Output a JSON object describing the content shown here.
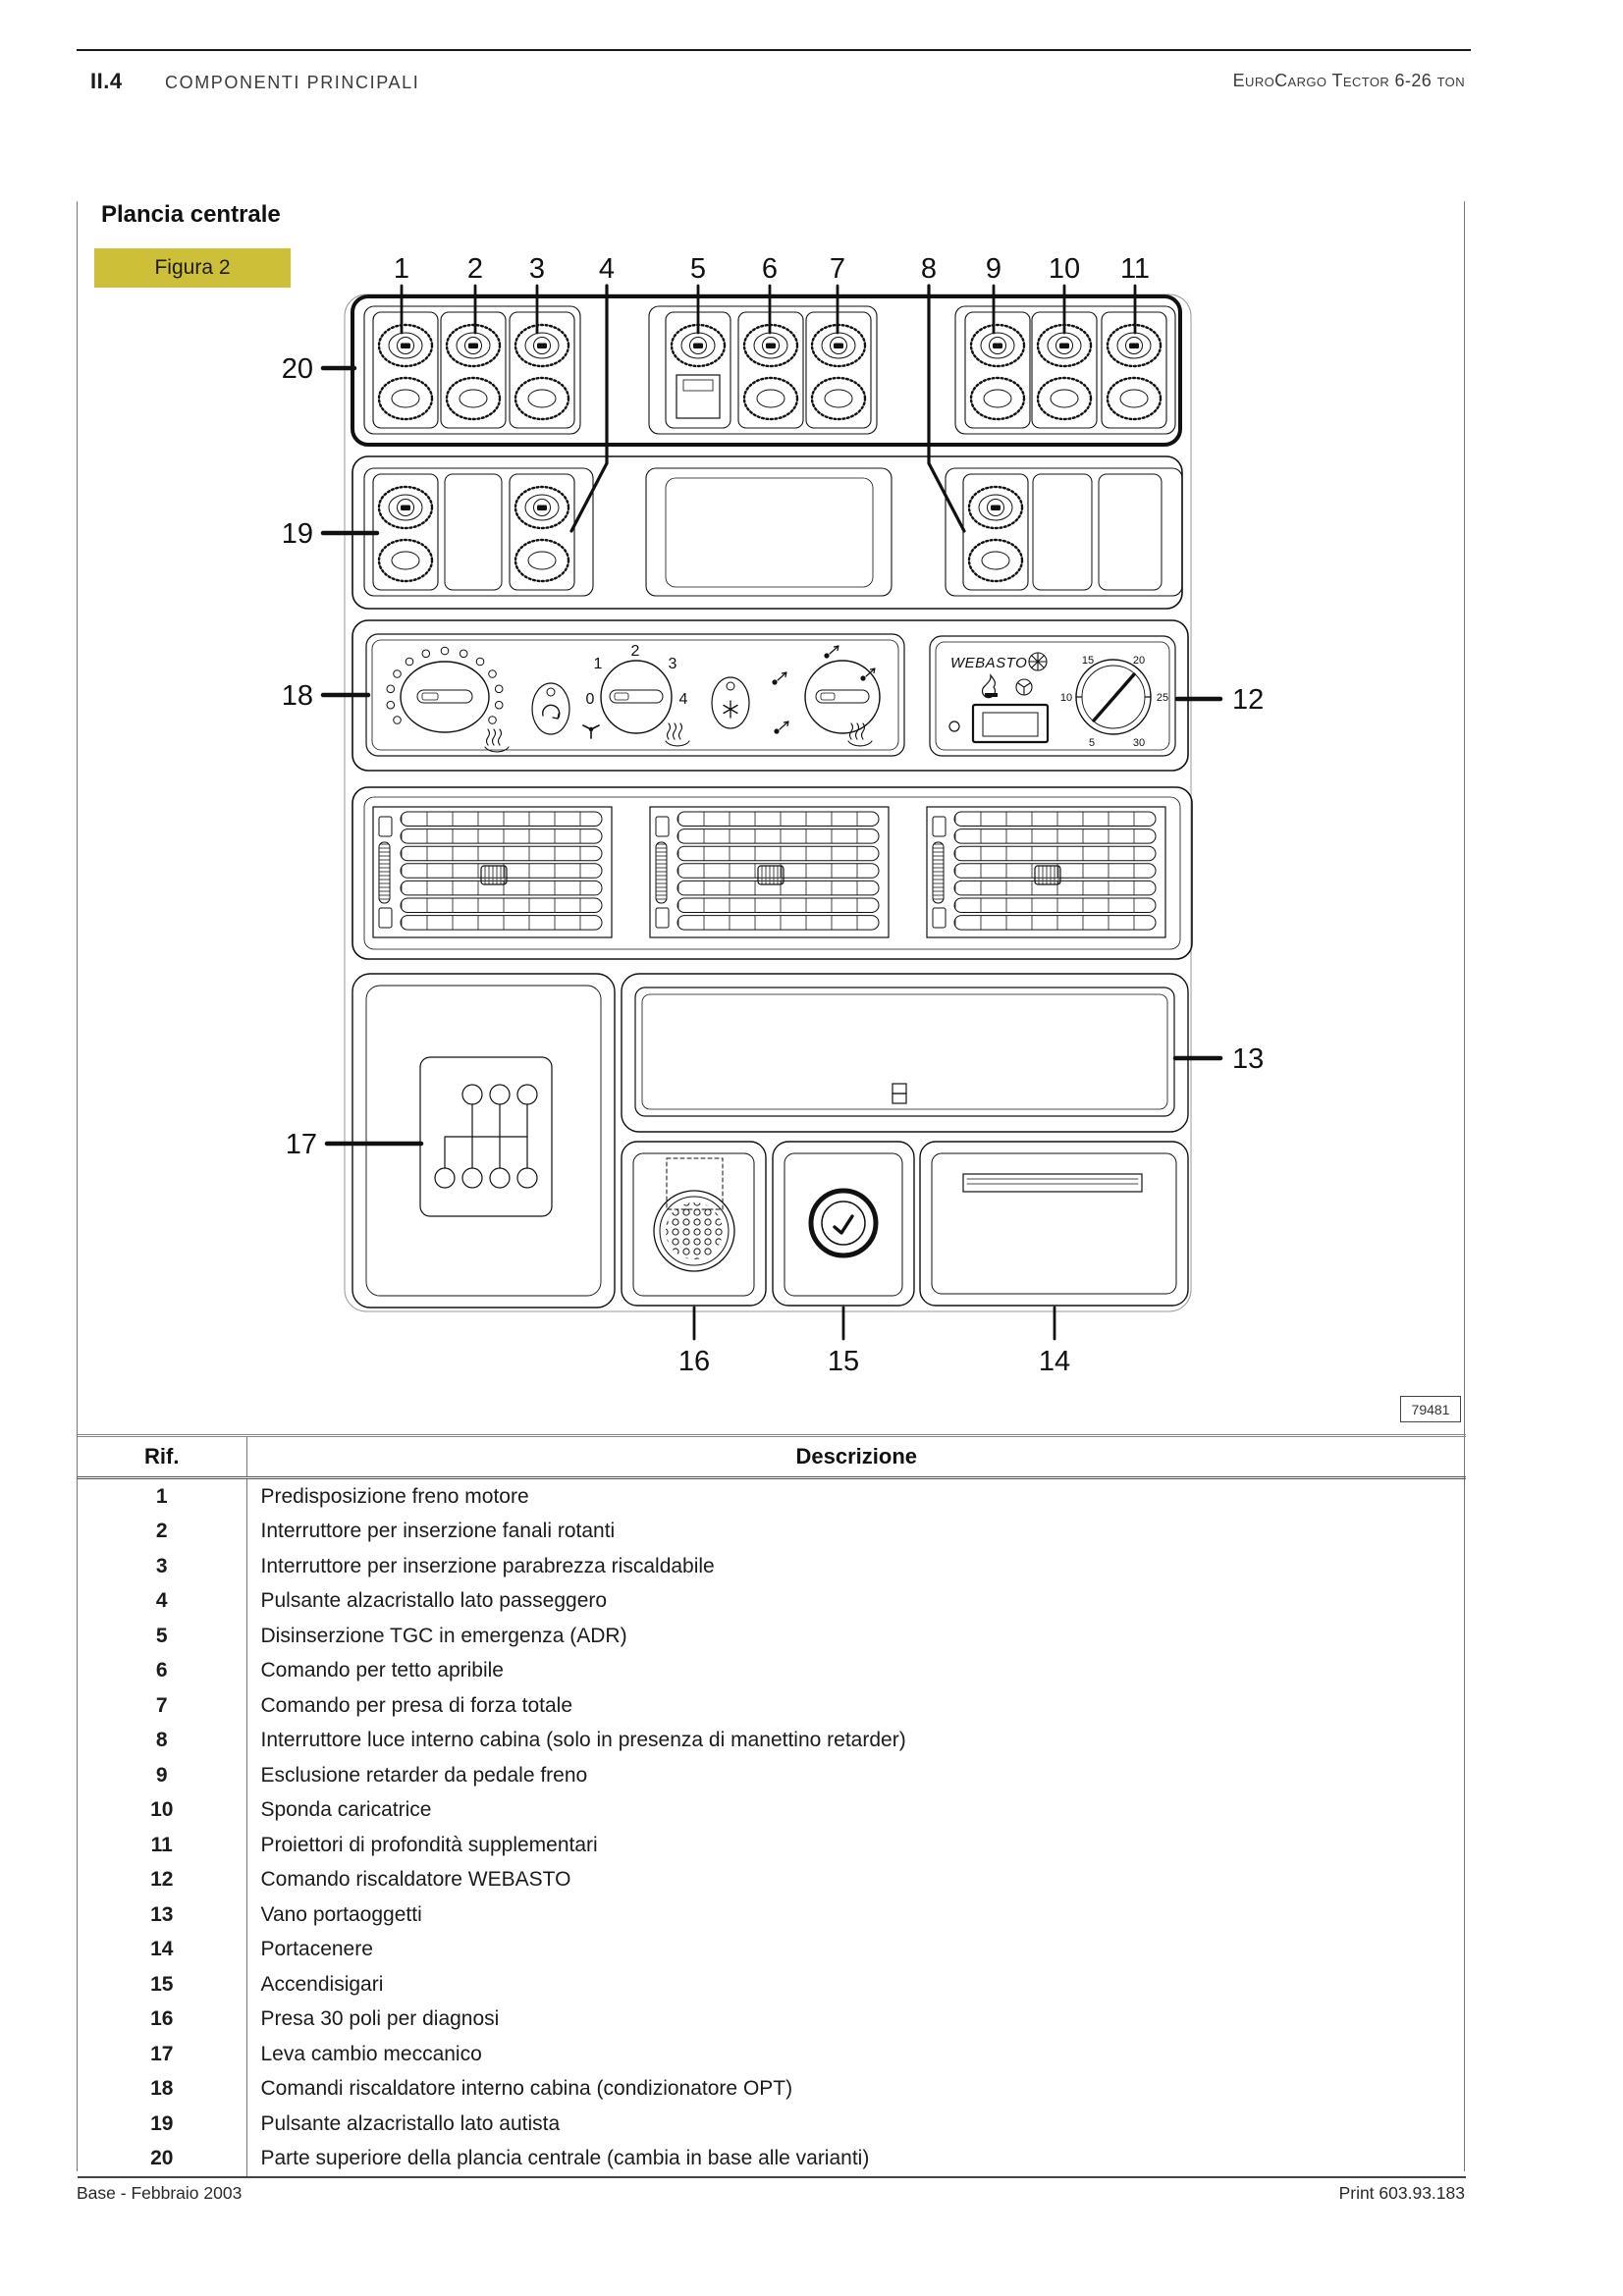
{
  "header": {
    "section": "II.4",
    "title": "COMPONENTI PRINCIPALI",
    "edition": "EuroCargo Tector 6-26 ton"
  },
  "figure": {
    "heading": "Plancia centrale",
    "label": "Figura 2",
    "code": "79481",
    "accent_color": "#cdbf37",
    "callouts": {
      "c1": "1",
      "c2": "2",
      "c3": "3",
      "c4": "4",
      "c5": "5",
      "c6": "6",
      "c7": "7",
      "c8": "8",
      "c9": "9",
      "c10": "10",
      "c11": "11",
      "c12": "12",
      "c13": "13",
      "c14": "14",
      "c15": "15",
      "c16": "16",
      "c17": "17",
      "c18": "18",
      "c19": "19",
      "c20": "20"
    },
    "webasto": {
      "brand": "WEBASTO",
      "dial": [
        "15",
        "20",
        "10",
        "25",
        "5",
        "30"
      ]
    },
    "fan_knob": {
      "speeds": [
        "1",
        "2",
        "3",
        "0",
        "4"
      ]
    }
  },
  "table": {
    "headers": {
      "ref": "Rif.",
      "desc": "Descrizione"
    },
    "rows": [
      {
        "ref": "1",
        "desc": "Predisposizione freno motore"
      },
      {
        "ref": "2",
        "desc": "Interruttore per inserzione fanali rotanti"
      },
      {
        "ref": "3",
        "desc": "Interruttore per inserzione parabrezza riscaldabile"
      },
      {
        "ref": "4",
        "desc": "Pulsante alzacristallo lato passeggero"
      },
      {
        "ref": "5",
        "desc": "Disinserzione TGC in emergenza (ADR)"
      },
      {
        "ref": "6",
        "desc": "Comando per tetto apribile"
      },
      {
        "ref": "7",
        "desc": "Comando per presa di forza totale"
      },
      {
        "ref": "8",
        "desc": "Interruttore luce interno cabina (solo in presenza di manettino retarder)"
      },
      {
        "ref": "9",
        "desc": "Esclusione retarder da pedale freno"
      },
      {
        "ref": "10",
        "desc": "Sponda caricatrice"
      },
      {
        "ref": "11",
        "desc": "Proiettori di profondità supplementari"
      },
      {
        "ref": "12",
        "desc": "Comando riscaldatore WEBASTO"
      },
      {
        "ref": "13",
        "desc": "Vano portaoggetti"
      },
      {
        "ref": "14",
        "desc": "Portacenere"
      },
      {
        "ref": "15",
        "desc": "Accendisigari"
      },
      {
        "ref": "16",
        "desc": "Presa 30 poli per diagnosi"
      },
      {
        "ref": "17",
        "desc": "Leva cambio meccanico"
      },
      {
        "ref": "18",
        "desc": "Comandi riscaldatore interno cabina (condizionatore OPT)"
      },
      {
        "ref": "19",
        "desc": "Pulsante alzacristallo lato autista"
      },
      {
        "ref": "20",
        "desc": "Parte superiore della plancia centrale (cambia in base alle varianti)"
      }
    ]
  },
  "footer": {
    "left": "Base - Febbraio 2003",
    "right": "Print 603.93.183"
  }
}
